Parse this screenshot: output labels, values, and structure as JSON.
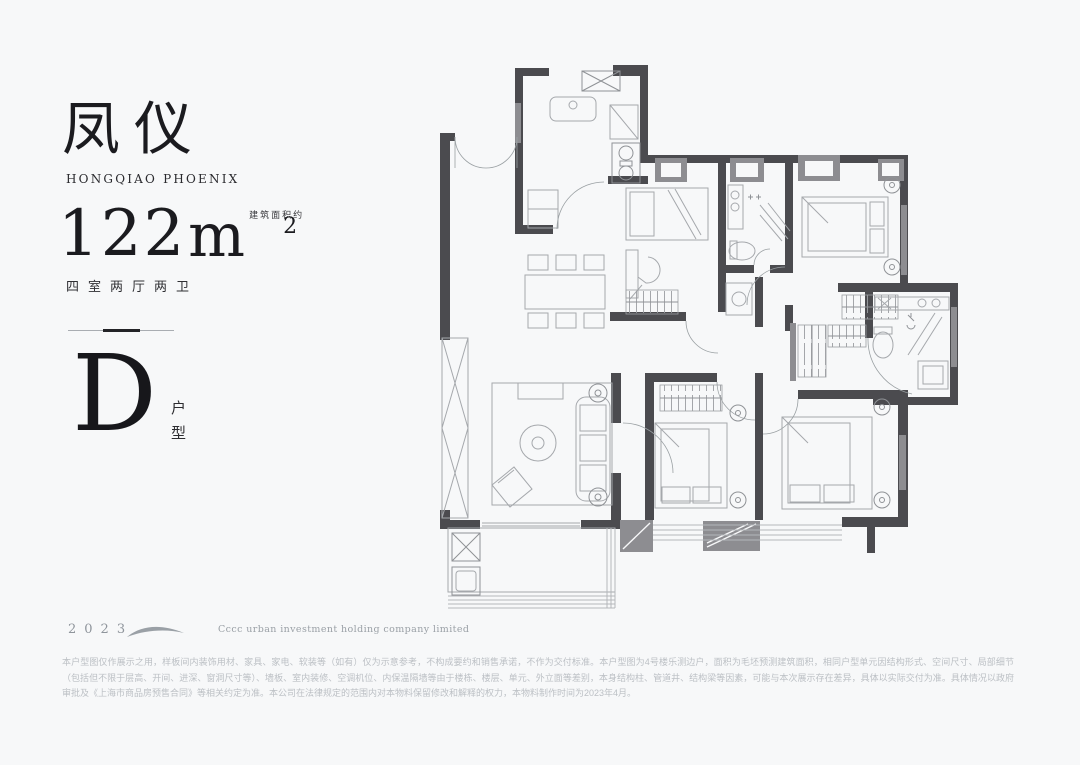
{
  "panel": {
    "title": "凤仪",
    "subtitle": "HONGQIAO PHOENIX",
    "area": {
      "note": "建筑面积约",
      "value": "122",
      "unit": "m",
      "superscript": "2"
    },
    "layout_desc": "四室两厅两卫",
    "unit_type": {
      "letter": "D",
      "label": "户型"
    },
    "footer": {
      "year": "2023",
      "company": "Cccc urban investment holding company limited"
    }
  },
  "disclaimer": {
    "text": "本户型图仅作展示之用，样板间内装饰用材、家具、家电、软装等（如有）仅为示意参考，不构成要约和销售承诺，不作为交付标准。本户型图为4号楼乐测边户，面积为毛坯预测建筑面积，相同户型单元因结构形式、空间尺寸、局部细节（包括但不限于层高、开间、进深、窗洞尺寸等）、墙板、室内装修、空调机位、内保温隔墙等由于楼栋、楼层、单元、外立面等差别，本身结构柱、管道井、结构梁等因素，可能与本次展示存在差异，具体以实际交付为准。具体情况以政府审批及《上海市商品房预售合同》等相关约定为准。本公司在法律规定的范围内对本物料保留修改和解释的权力，本物料制作时间为2023年4月。"
  },
  "colors": {
    "background": "#f7f8f9",
    "ink": "#1b1b1f",
    "wall_dark": "#4b4b4f",
    "wall_medium": "#8d8d91",
    "furniture_line": "#a5a8ac",
    "muted_text": "#9aa0a6",
    "disclaimer_text": "#bcc0c5"
  }
}
